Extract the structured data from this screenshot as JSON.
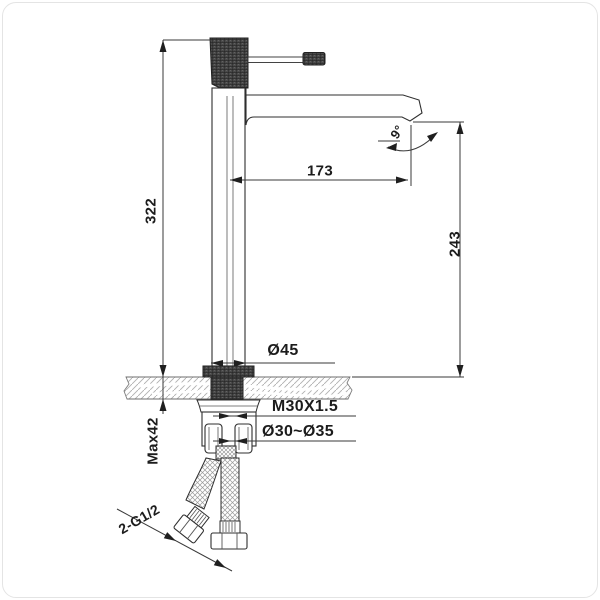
{
  "drawing": {
    "type": "tall basin mixer faucet installation drawing",
    "labels": {
      "overall_height": "322",
      "max_deck_thickness": "Max42",
      "spout_reach": "173",
      "outlet_height": "243",
      "spout_angle": "9°",
      "body_diameter": "Ø45",
      "thread_spec": "M30X1.5",
      "hole_range": "Ø30~Ø35",
      "hose_thread": "2-G1/2"
    }
  }
}
